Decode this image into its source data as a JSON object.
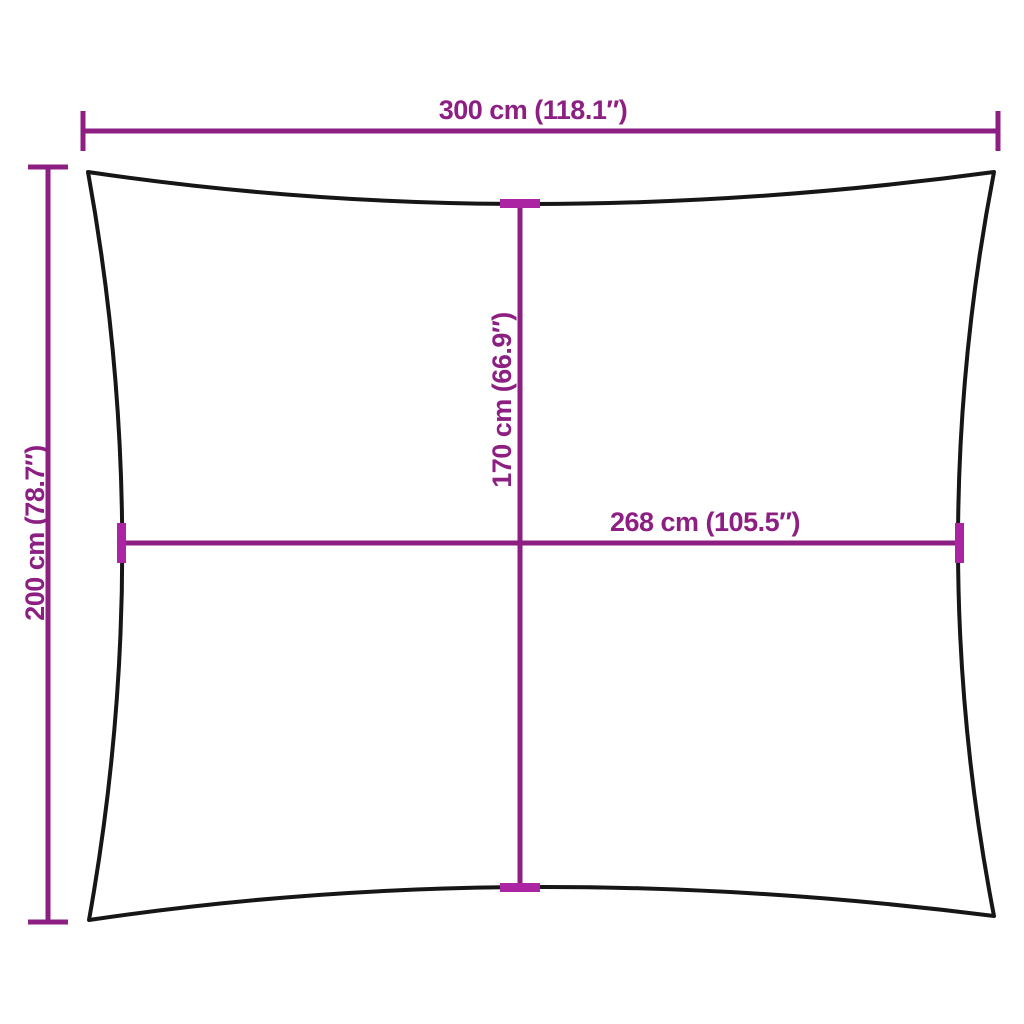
{
  "colors": {
    "background": "#ffffff",
    "outline": "#161616",
    "dimension": "#8d1f83",
    "tick": "#ab24a2"
  },
  "dimensions": {
    "width": {
      "label": "300 cm (118.1″)",
      "cm": 300,
      "inches": 118.1
    },
    "height": {
      "label": "200 cm (78.7″)",
      "cm": 200,
      "inches": 78.7
    },
    "inner_width": {
      "label": "268 cm (105.5″)",
      "cm": 268,
      "inches": 105.5
    },
    "inner_height": {
      "label": "170 cm (66.9″)",
      "cm": 170,
      "inches": 66.9
    }
  }
}
